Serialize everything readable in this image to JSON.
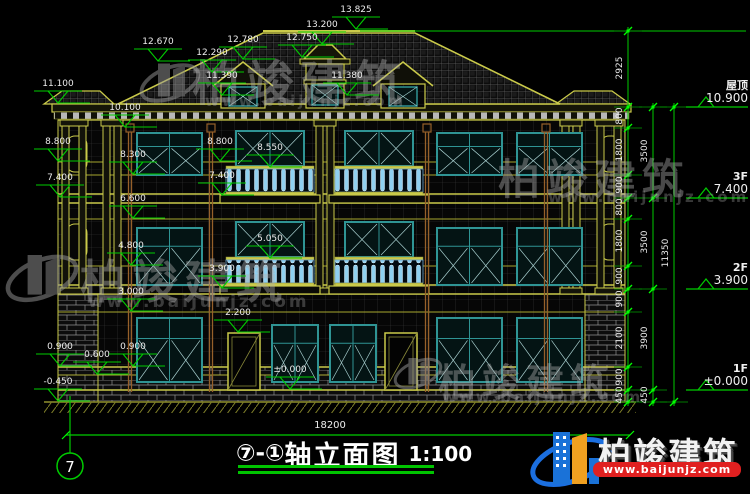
{
  "title": {
    "axis": "⑦-①",
    "name": "轴立面图",
    "scale": "1:100"
  },
  "axis_bubble": "7",
  "bottom": {
    "dim": "18200"
  },
  "levels": [
    {
      "label": "屋顶",
      "value": "10.900",
      "y": 107
    },
    {
      "label": "3F",
      "value": "7.400",
      "y": 198
    },
    {
      "label": "2F",
      "value": "3.900",
      "y": 289
    },
    {
      "label": "1F",
      "value": "±0.000",
      "y": 390
    }
  ],
  "dims": {
    "chain1": [
      {
        "v": "2925",
        "y": 69
      },
      {
        "v": "800",
        "y": 117
      },
      {
        "v": "1800",
        "y": 151
      },
      {
        "v": "900",
        "y": 186
      },
      {
        "v": "800",
        "y": 208
      },
      {
        "v": "1800",
        "y": 242
      },
      {
        "v": "900",
        "y": 277
      },
      {
        "v": "900",
        "y": 300
      },
      {
        "v": "2100",
        "y": 339
      },
      {
        "v": "900",
        "y": 378
      },
      {
        "v": "450",
        "y": 396
      }
    ],
    "chain2": [
      {
        "v": "3500",
        "y": 152
      },
      {
        "v": "3500",
        "y": 243
      },
      {
        "v": "3900",
        "y": 339
      },
      {
        "v": "450",
        "y": 396
      }
    ],
    "total": {
      "v": "11350",
      "y": 254
    }
  },
  "marks": [
    {
      "v": "13.825",
      "x": 356,
      "y": 30
    },
    {
      "v": "12.670",
      "x": 158,
      "y": 62
    },
    {
      "v": "12.780",
      "x": 243,
      "y": 60
    },
    {
      "v": "12.290",
      "x": 212,
      "y": 73
    },
    {
      "v": "11.390",
      "x": 222,
      "y": 96
    },
    {
      "v": "13.200",
      "x": 322,
      "y": 45
    },
    {
      "v": "12.750",
      "x": 302,
      "y": 58
    },
    {
      "v": "11.380",
      "x": 347,
      "y": 96
    },
    {
      "v": "11.100",
      "x": 58,
      "y": 104
    },
    {
      "v": "10.100",
      "x": 125,
      "y": 128
    },
    {
      "v": "8.800",
      "x": 58,
      "y": 162
    },
    {
      "v": "8.800",
      "x": 220,
      "y": 162
    },
    {
      "v": "8.550",
      "x": 270,
      "y": 168
    },
    {
      "v": "8.300",
      "x": 133,
      "y": 175
    },
    {
      "v": "7.400",
      "x": 60,
      "y": 198
    },
    {
      "v": "7.400",
      "x": 222,
      "y": 196
    },
    {
      "v": "6.600",
      "x": 133,
      "y": 219
    },
    {
      "v": "5.050",
      "x": 270,
      "y": 259
    },
    {
      "v": "4.800",
      "x": 131,
      "y": 266
    },
    {
      "v": "3.900",
      "x": 222,
      "y": 289
    },
    {
      "v": "3.000",
      "x": 131,
      "y": 312
    },
    {
      "v": "2.200",
      "x": 238,
      "y": 333
    },
    {
      "v": "0.900",
      "x": 60,
      "y": 367
    },
    {
      "v": "0.600",
      "x": 97,
      "y": 375
    },
    {
      "v": "0.900",
      "x": 133,
      "y": 367
    },
    {
      "v": "±0.000",
      "x": 290,
      "y": 390
    },
    {
      "v": "-0.450",
      "x": 58,
      "y": 402
    }
  ],
  "watermark": {
    "brand": "柏竣建筑",
    "url": "www.baijunjz.com"
  },
  "footer": {
    "brand": "柏竣建筑",
    "url": "www.baijunjz.com"
  },
  "colors": {
    "cad_yellow": "#caca4a",
    "dim_green": "#00cc00",
    "window_teal": "#2f9494",
    "baluster_blue": "#8fd0f0",
    "logo_blue": "#1a72d8",
    "logo_orange": "#f0a020",
    "url_red": "#e02020"
  }
}
